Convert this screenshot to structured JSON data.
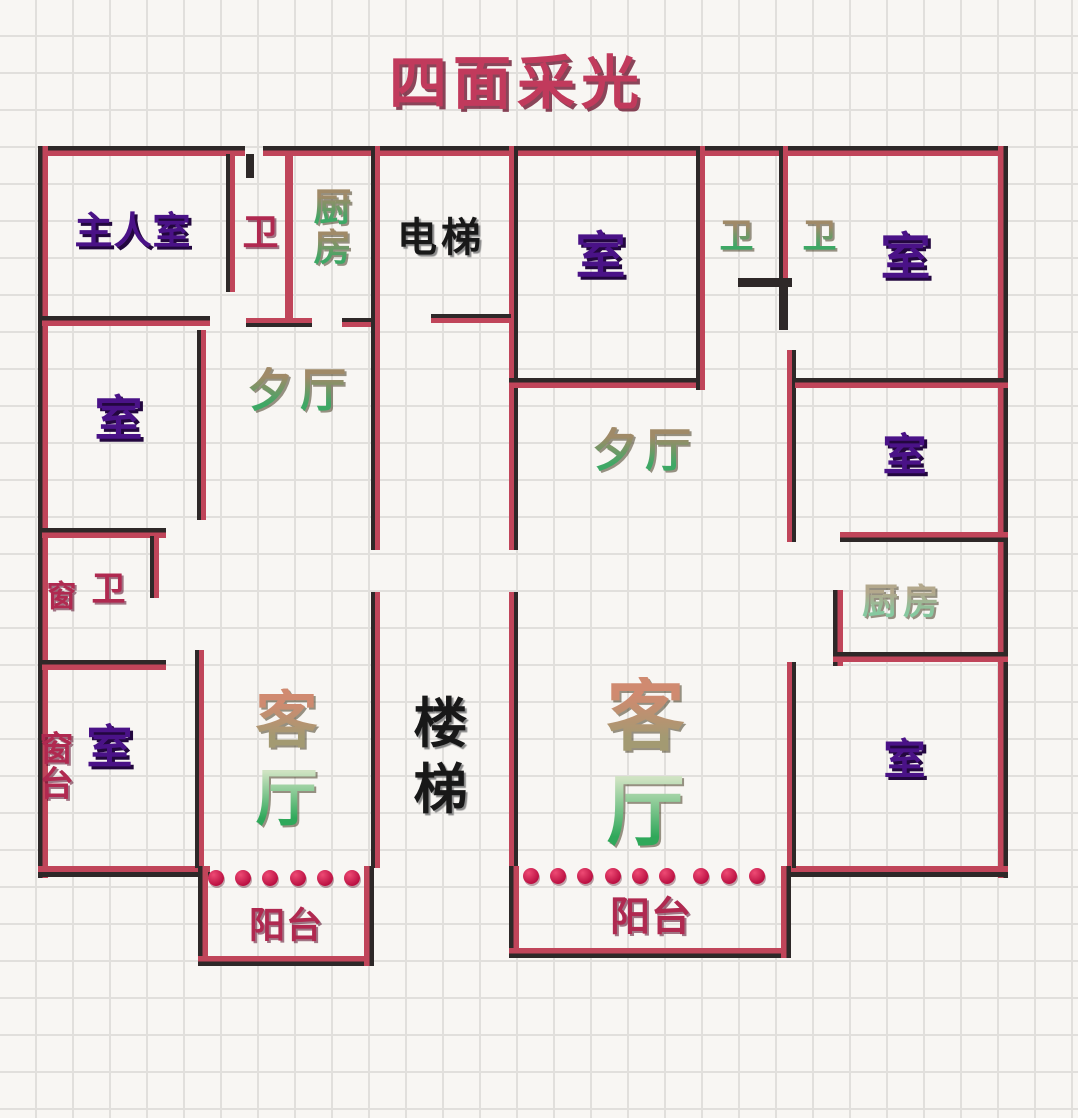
{
  "title": "四面采光",
  "colors": {
    "title": "#c13a5c",
    "room_purple": "#4a1287",
    "crimson": "#b02950",
    "wall_dark": "#2e2828",
    "wall_red": "#c0455a",
    "window_dot": "#d81b4c",
    "label_green": "#3da865",
    "label_tan": "#a08a68",
    "grid_line": "#e1dfdc",
    "paper": "#f8f6f3"
  },
  "rooms": {
    "master": {
      "label": "主人室"
    },
    "bath_top_left": {
      "label": "卫"
    },
    "kitchen_left": {
      "chars": [
        "厨",
        "房"
      ]
    },
    "elevator": {
      "label": "电梯"
    },
    "room_mid_top": {
      "label": "室"
    },
    "bath_top_right_1": {
      "label": "卫"
    },
    "bath_top_right_2": {
      "label": "卫"
    },
    "room_top_right": {
      "label": "室"
    },
    "dining_left": {
      "chars": [
        "夕",
        "厅"
      ]
    },
    "dining_right": {
      "chars": [
        "夕",
        "厅"
      ]
    },
    "room_left_mid": {
      "label": "室"
    },
    "window_left": {
      "label": "窗"
    },
    "bath_left_small": {
      "label": "卫"
    },
    "window_sill": {
      "chars": [
        "窗",
        "台"
      ]
    },
    "room_bottom_left": {
      "label": "室"
    },
    "living_left": {
      "chars": [
        "客",
        "厅"
      ]
    },
    "stairs": {
      "chars": [
        "楼",
        "梯"
      ]
    },
    "living_right": {
      "chars": [
        "客",
        "厅"
      ]
    },
    "room_right_mid": {
      "label": "室"
    },
    "kitchen_right": {
      "chars": [
        "厨",
        "房"
      ]
    },
    "room_bottom_right": {
      "label": "室"
    },
    "balcony_left": {
      "label": "阳台"
    },
    "balcony_right": {
      "label": "阳台"
    }
  }
}
